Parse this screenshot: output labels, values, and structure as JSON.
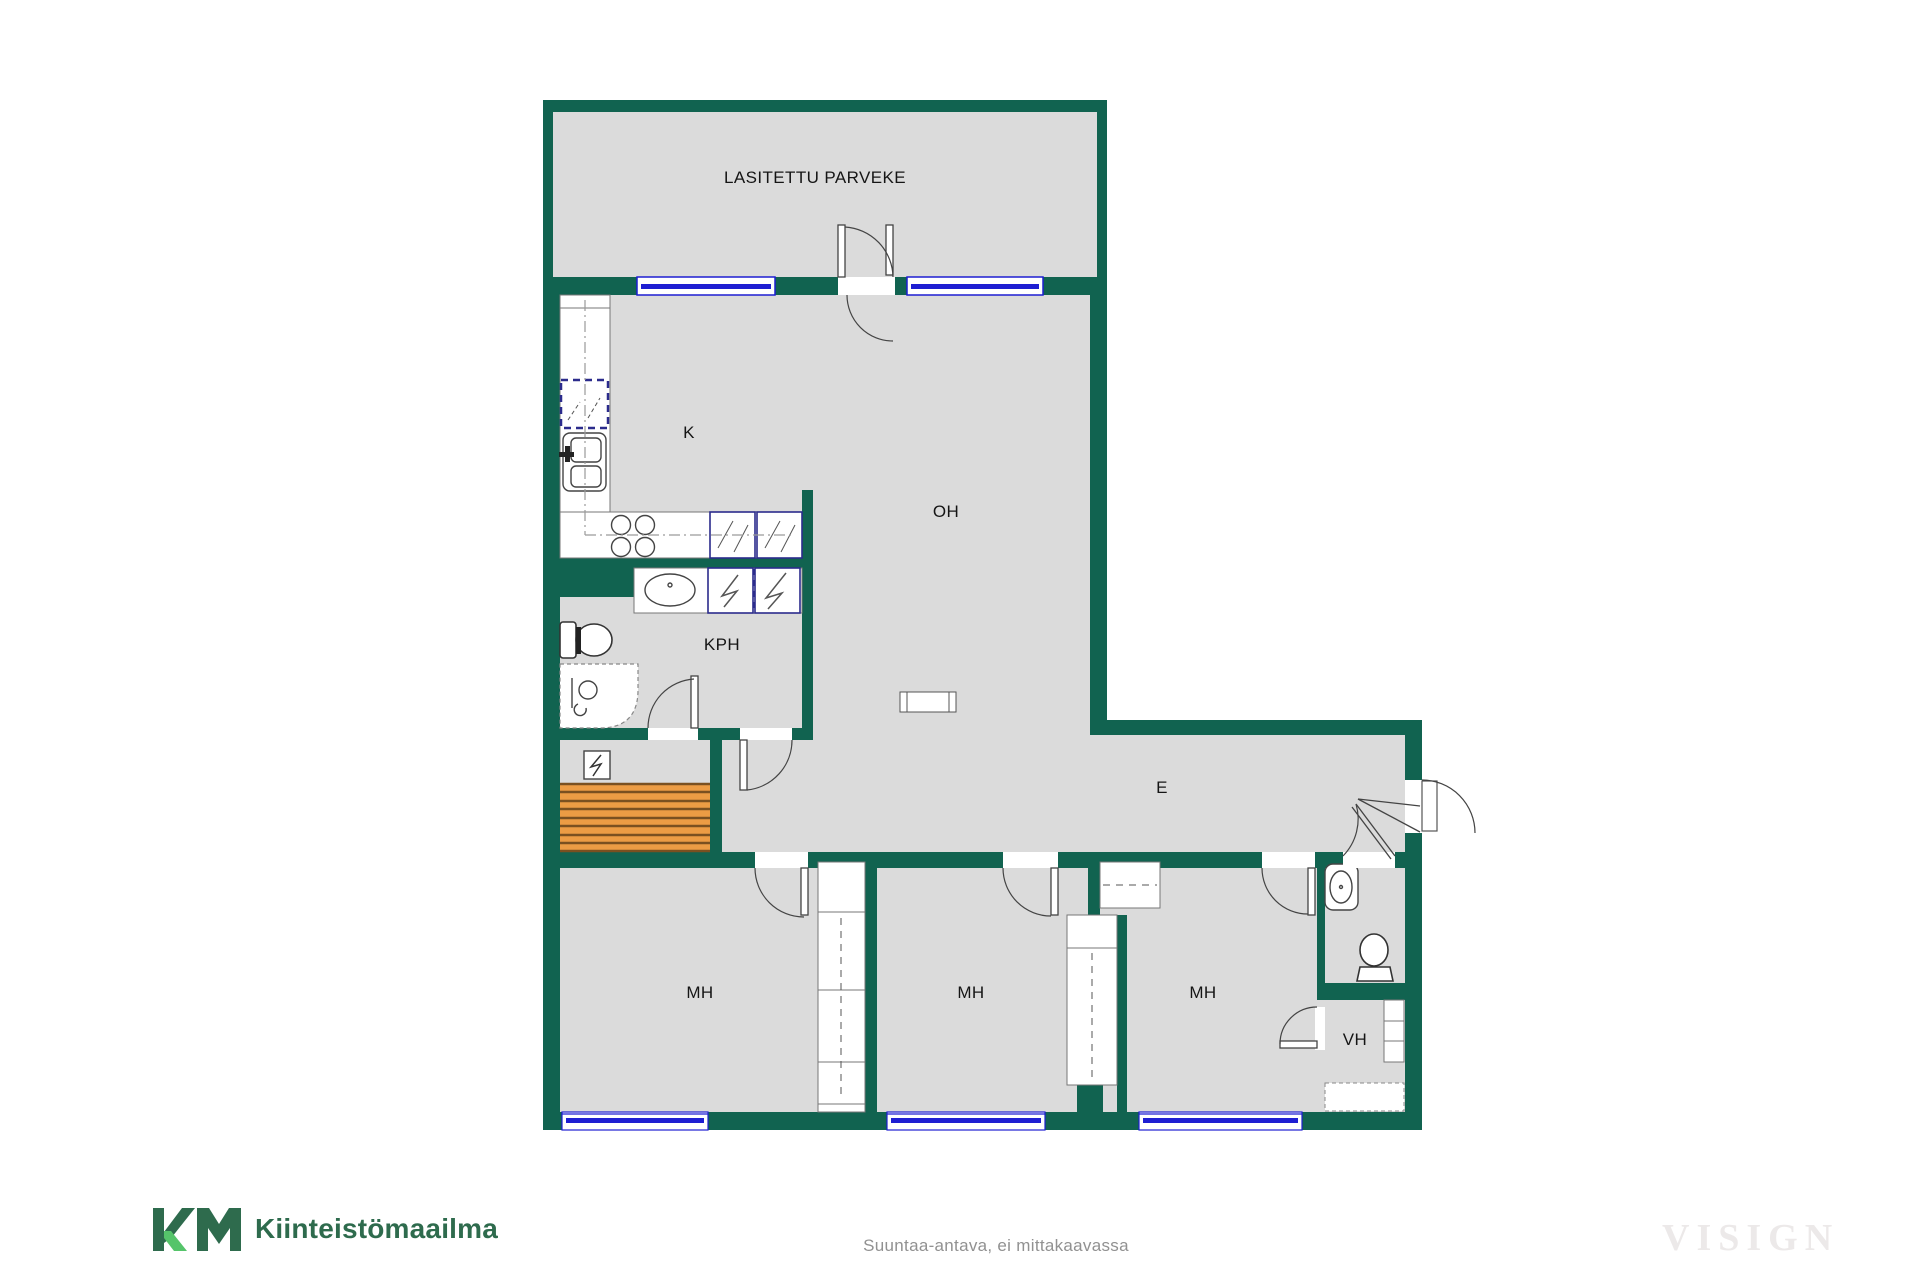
{
  "plan": {
    "type": "apartment-floor-plan",
    "rooms": {
      "balcony": {
        "label": "LASITETTU PARVEKE"
      },
      "kitchen": {
        "label": "K"
      },
      "living_room": {
        "label": "OH"
      },
      "bathroom": {
        "label": "KPH"
      },
      "entry": {
        "label": "E"
      },
      "bedroom_1": {
        "label": "MH"
      },
      "bedroom_2": {
        "label": "MH"
      },
      "bedroom_3": {
        "label": "MH"
      },
      "walk_in_closet": {
        "label": "VH"
      }
    },
    "fixtures": [
      "kitchen-sink-icon",
      "stove-icon",
      "fridge-reservation-icon",
      "appliance-reservation-icon",
      "washer-reservation-icon",
      "dryer-reservation-icon",
      "bathroom-basin-icon",
      "toilet-icon",
      "shower-icon",
      "sauna-heater-icon",
      "sauna-benches",
      "wardrobe",
      "closet-shelf",
      "window",
      "door-swing",
      "entrance-door"
    ],
    "colors": {
      "wall_green": "#116350",
      "floor_gray": "#DBDBDB",
      "window_blue": "#1E1ED2",
      "appliance_navy": "#2B2B8C",
      "bench_orange": "#EC9C44",
      "bench_line": "#7A5020",
      "fixture_line": "#444444"
    }
  },
  "footer": {
    "logo_monogram": "KM",
    "logo_text": "Kiinteistömaailma",
    "logo_green": "#2E6B4D",
    "logo_light_green": "#55C46A",
    "disclaimer": "Suuntaa-antava, ei mittakaavassa",
    "watermark": "VISIGN"
  }
}
